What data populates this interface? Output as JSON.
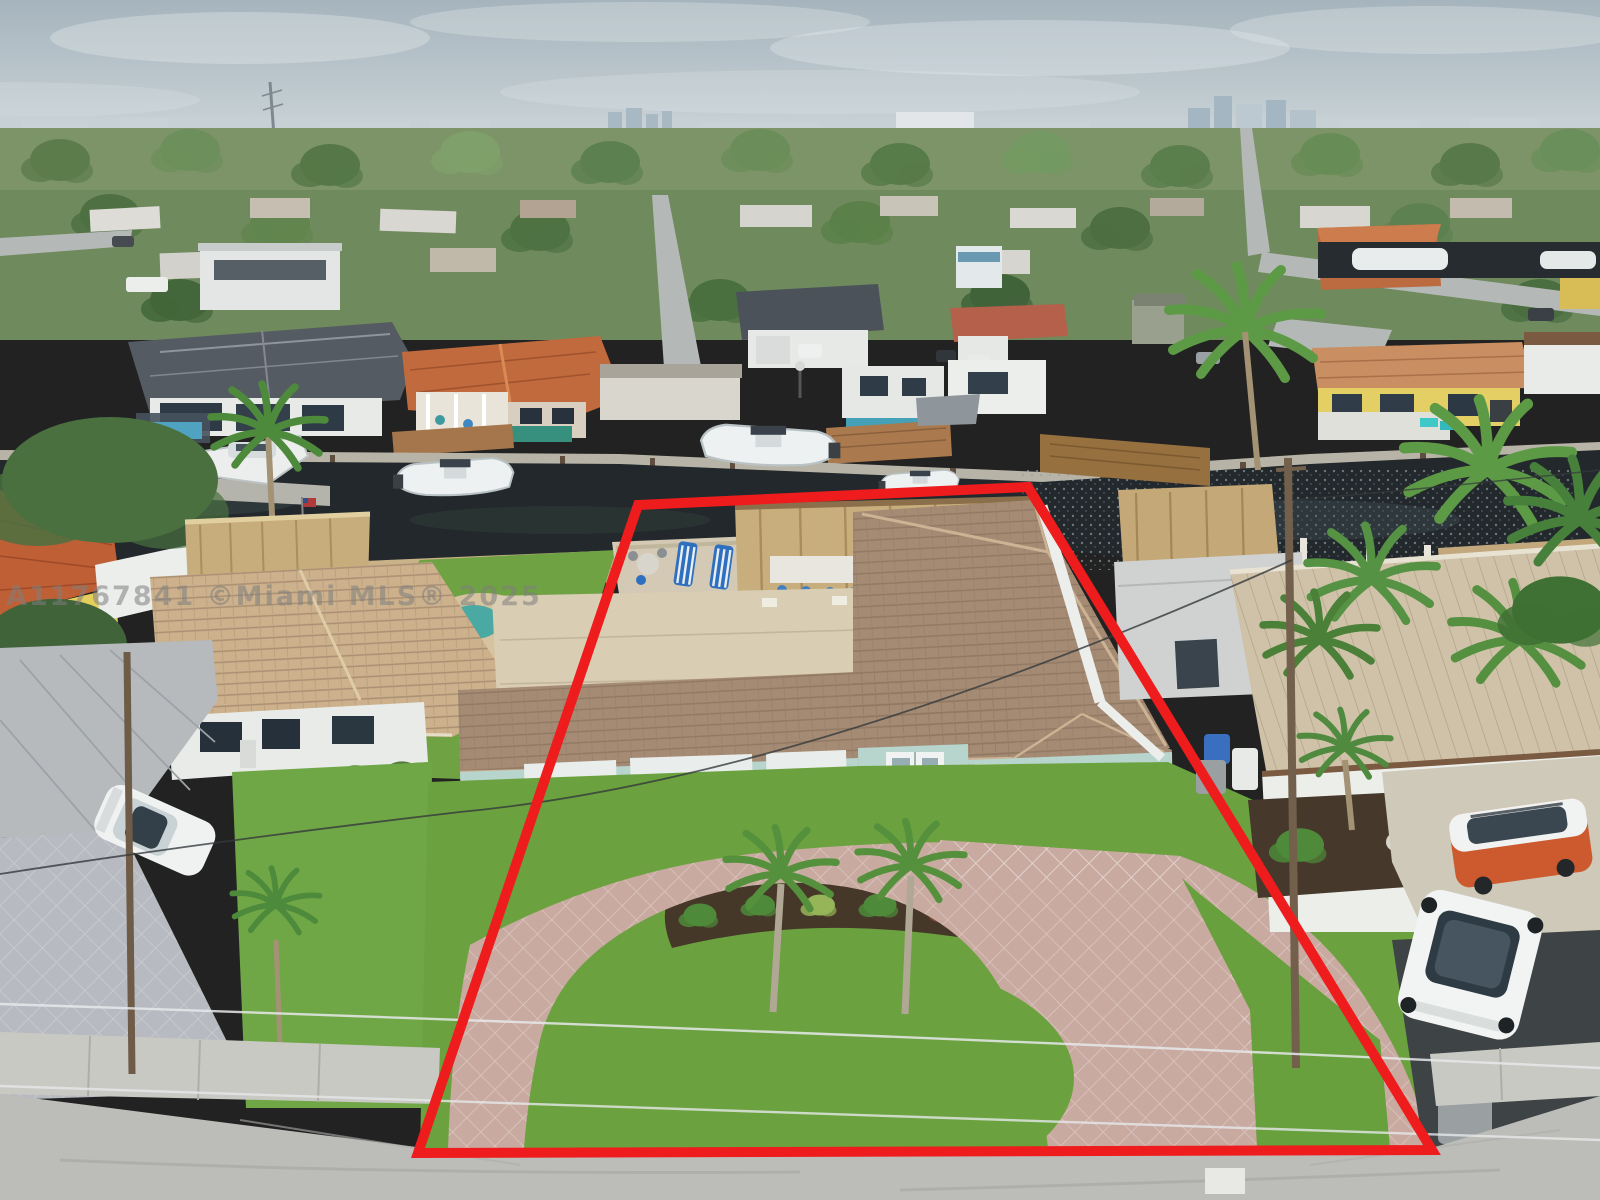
{
  "watermark": {
    "text": "A11767841 ©Miami MLS® 2025"
  },
  "colors": {
    "property_outline": "#ee1c1c",
    "sky_top": "#a6b4bd",
    "sky_bottom": "#cfd8db",
    "canal_water": "#22282b",
    "lawn_grass": "#6ba23f",
    "driveway_pavers": "#c9aaa1",
    "subject_roof": "#a58b74",
    "subject_walls": "#b7d4cd",
    "watermark": "rgba(125,125,125,0.55)"
  },
  "scene": {
    "setting": "Aerial drone photo of a waterfront residential neighborhood on a canal, cloudy sky, distant city skyline",
    "subject_property": {
      "boundary": "red outlined lot",
      "features": [
        "single-story light-blue house with tan barrel-tile roof",
        "white two-car garage door",
        "double entry doors with white hurricane shutter panels",
        "circular paver driveway with center grass island",
        "two royal palm trees in front island",
        "thatched tiki hut with bar and blue stools on waterfront patio",
        "blue striped lounge chairs and patio table",
        "flat-roof rear wing",
        "white perimeter fence",
        "blue recycling bin beside garage",
        "concrete seawall and dock on canal"
      ]
    },
    "canal": {
      "boats": [
        "white yacht on boat lift",
        "white center-console fishing boat",
        "small center-console boat",
        "moored white boats in rear canal"
      ],
      "details": [
        "wood docks with pilings",
        "american flag on dock post"
      ]
    },
    "neighbors": {
      "left": [
        "tan tile-roof house with flat carport",
        "white sedan on gray paver driveway",
        "round pool patio",
        "thatched tiki hut at seawall",
        "yellow house with orange tile roof at corner"
      ],
      "right": [
        "white house with tan metal roof and brown fascia",
        "gray flat-roof outbuilding with thatched shed",
        "orange-and-white van",
        "white SUV on dark asphalt driveway",
        "gray trash bin at curb"
      ]
    },
    "across_canal": [
      "white house with dark slate hip roof, pool and pergola",
      "house with orange tile roof and covered porch",
      "white houses with pool, wood deck and gazebo",
      "yellow house with tan tile roof and patio",
      "palm trees along seawall"
    ],
    "background": [
      "suburban rooftops among dense palms and trees",
      "radio antenna tower",
      "high-rise skyline on horizon",
      "neighborhood streets with parked cars"
    ],
    "street_area": [
      "concrete street",
      "sidewalk and grass parkway",
      "paver driveway aprons",
      "utility poles with power lines",
      "storm drain panel"
    ]
  }
}
